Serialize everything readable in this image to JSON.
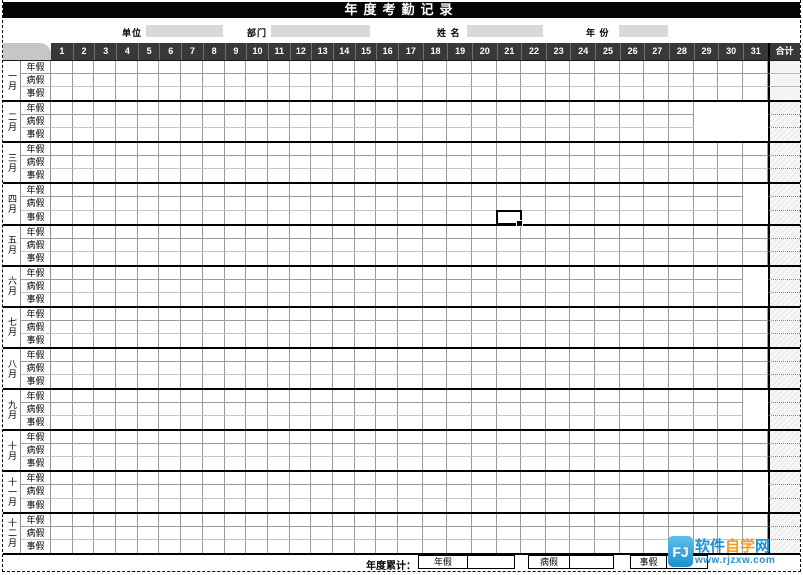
{
  "title": "年度考勤记录",
  "info_fields": [
    {
      "label": "单位",
      "value": ""
    },
    {
      "label": "部门",
      "value": ""
    },
    {
      "label": "姓 名",
      "value": ""
    },
    {
      "label": "年 份",
      "value": ""
    }
  ],
  "table": {
    "day_headers": [
      "1",
      "2",
      "3",
      "4",
      "5",
      "6",
      "7",
      "8",
      "9",
      "10",
      "11",
      "12",
      "13",
      "14",
      "15",
      "16",
      "17",
      "18",
      "19",
      "20",
      "21",
      "22",
      "23",
      "24",
      "25",
      "26",
      "27",
      "28",
      "29",
      "30",
      "31"
    ],
    "total_header": "合计",
    "leave_types": [
      "年假",
      "病假",
      "事假"
    ],
    "months": [
      {
        "name": "一月",
        "days": 31
      },
      {
        "name": "二月",
        "days": 28
      },
      {
        "name": "三月",
        "days": 31
      },
      {
        "name": "四月",
        "days": 30
      },
      {
        "name": "五月",
        "days": 31
      },
      {
        "name": "六月",
        "days": 30
      },
      {
        "name": "七月",
        "days": 31
      },
      {
        "name": "八月",
        "days": 31
      },
      {
        "name": "九月",
        "days": 30
      },
      {
        "name": "十月",
        "days": 31
      },
      {
        "name": "十一月",
        "days": 30
      },
      {
        "name": "十二月",
        "days": 31
      }
    ]
  },
  "selection": {
    "month": "四月",
    "leave_type": "事假",
    "day": 21
  },
  "footer": {
    "label": "年度累计：",
    "fields": [
      {
        "label": "年假",
        "value": ""
      },
      {
        "label": "病假",
        "value": ""
      },
      {
        "label": "事假",
        "value": ""
      }
    ]
  },
  "watermark": {
    "site_parts": [
      "软件",
      "自学",
      "网"
    ],
    "site_name": "软件自学网",
    "url": "www.rjzxw.com",
    "icon": "FJ"
  },
  "colors": {
    "header_bg": "#383838",
    "corner_bg": "#c6c6c6",
    "info_box_bg": "#d9d9d9",
    "logo_blue": "#1b8fd0",
    "logo_orange": "#f29b1d"
  }
}
